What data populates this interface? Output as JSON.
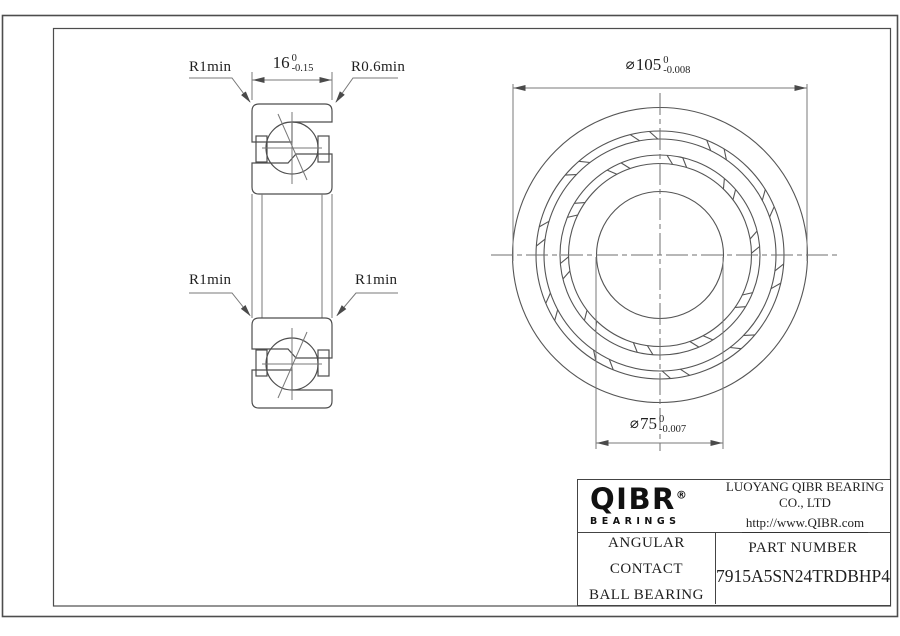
{
  "drawing": {
    "section_view": {
      "label_r1min_top": "R1min",
      "label_r06min": "R0.6min",
      "label_r1min_mid_left": "R1min",
      "label_r1min_mid_right": "R1min",
      "width_dim": {
        "value": "16",
        "tol_upper": "0",
        "tol_lower": "-0.15"
      }
    },
    "front_view": {
      "outer_dim": {
        "symbol": "⌀",
        "value": "105",
        "tol_upper": "0",
        "tol_lower": "-0.008"
      },
      "bore_dim": {
        "symbol": "⌀",
        "value": "75",
        "tol_upper": "0",
        "tol_lower": "-0.007"
      }
    }
  },
  "title_block": {
    "logo_text": "QIBR",
    "logo_registered": "®",
    "logo_subtext": "BEARINGS",
    "company_name": "LUOYANG QIBR BEARING CO., LTD",
    "company_url": "http://www.QIBR.com",
    "product_type_line1": "ANGULAR CONTACT",
    "product_type_line2": "BALL BEARING",
    "part_number_label": "PART NUMBER",
    "part_number_value": "7915A5SN24TRDBHP4"
  },
  "colors": {
    "line": "#4d4d4d",
    "dim_line": "#787878",
    "text": "#1f1f1f",
    "border": "#444444"
  }
}
